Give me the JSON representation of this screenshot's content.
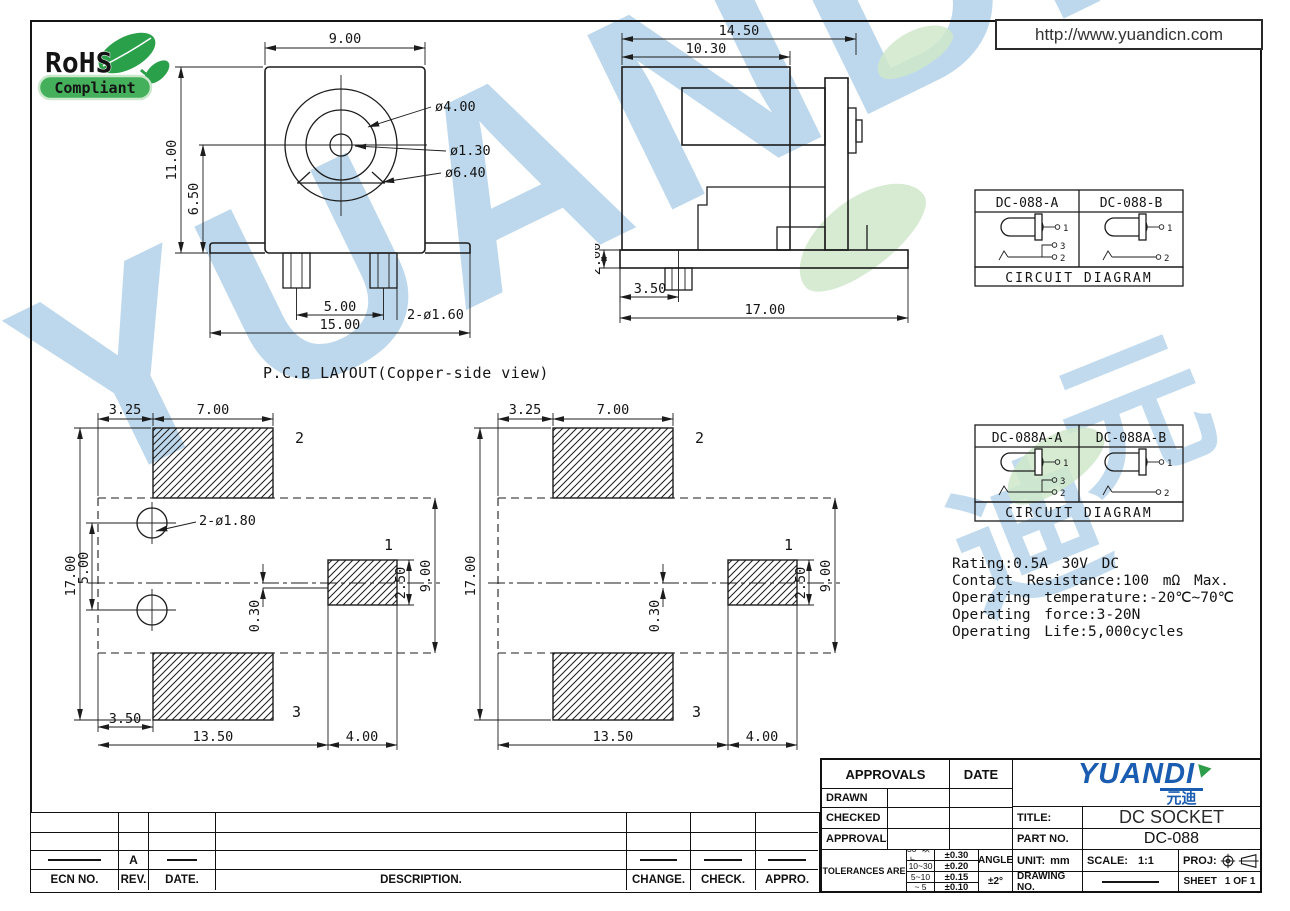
{
  "header": {
    "url": "http://www.yuandicn.com",
    "rohs_line1": "RoHS",
    "rohs_line2": "Compliant"
  },
  "watermark": {
    "brand": "YUANDI",
    "cjk1": "元",
    "cjk2": "迪"
  },
  "captions": {
    "pcb_layout": "P.C.B LAYOUT(Copper-side view)"
  },
  "front_view": {
    "width": "9.00",
    "height": "11.00",
    "center_height": "6.50",
    "dia_ring": "ø4.00",
    "dia_pin": "ø1.30",
    "dia_outer": "ø6.40",
    "pin_pitch": "5.00",
    "total_width": "15.00",
    "pin_holes": "2-ø1.60"
  },
  "side_view": {
    "total_width": "14.50",
    "body_width": "10.30",
    "base_thickness": "2.00",
    "pin_offset": "3.50",
    "total_length": "17.00"
  },
  "pcb_layout_1": {
    "margin": "3.25",
    "pad_width": "7.00",
    "total_height": "17.00",
    "hole_pitch": "5.00",
    "hole_note": "2-ø1.80",
    "offset": "0.30",
    "pad1_height": "2.50",
    "span": "9.00",
    "margin_b": "3.50",
    "length": "13.50",
    "pad1_offset": "4.00",
    "pad1": "1",
    "pad2": "2",
    "pad3": "3"
  },
  "pcb_layout_2": {
    "margin": "3.25",
    "pad_width": "7.00",
    "total_height": "17.00",
    "offset": "0.30",
    "pad1_height": "2.50",
    "span": "9.00",
    "length": "13.50",
    "pad1_offset": "4.00",
    "pad1": "1",
    "pad2": "2",
    "pad3": "3"
  },
  "circuit_1": {
    "model_a": "DC-088-A",
    "model_b": "DC-088-B",
    "caption": "CIRCUIT DIAGRAM",
    "pin1": "1",
    "pin2": "2",
    "pin3": "3"
  },
  "circuit_2": {
    "model_a": "DC-088A-A",
    "model_b": "DC-088A-B",
    "caption": "CIRCUIT DIAGRAM",
    "pin1": "1",
    "pin2": "2",
    "pin3": "3"
  },
  "specs": {
    "line1": "Rating:0.5A 30V DC",
    "line2": "Contact Resistance:100 mΩ Max.",
    "line3": "Operating temperature:-20℃~70℃",
    "line4": "Operating force:3-20N",
    "line5": "Operating Life:5,000cycles"
  },
  "title_block": {
    "approvals_header": "APPROVALS",
    "date_header": "DATE",
    "drawn_label": "DRAWN",
    "checked_label": "CHECKED",
    "approvals_label": "APPROVALS",
    "tolerances_label": "TOLERANCES ARE",
    "tol_range_1": "30~以上",
    "tol_val_1": "±0.30",
    "tol_range_2": "10~30",
    "tol_val_2": "±0.20",
    "tol_range_3": "5~10",
    "tol_val_3": "±0.15",
    "tol_range_4": "~ 5",
    "tol_val_4": "±0.10",
    "angle_label": "ANGLE",
    "angle_value": "±2°",
    "brand": "YUANDI",
    "brand_cjk": "元迪",
    "title_label": "TITLE:",
    "title_value": "DC SOCKET",
    "part_label": "PART NO.",
    "part_value": "DC-088",
    "unit_label": "UNIT:",
    "unit_value": "mm",
    "scale_label": "SCALE:",
    "scale_value": "1:1",
    "proj_label": "PROJ:",
    "drawing_label": "DRAWING NO.",
    "sheet_label": "SHEET",
    "sheet_value": "1 OF 1"
  },
  "revision_table": {
    "headers": {
      "ecn": "ECN NO.",
      "rev": "REV.",
      "date": "DATE.",
      "description": "DESCRIPTION.",
      "change": "CHANGE.",
      "check": "CHECK.",
      "appro": "APPRO."
    },
    "revision": "A"
  }
}
